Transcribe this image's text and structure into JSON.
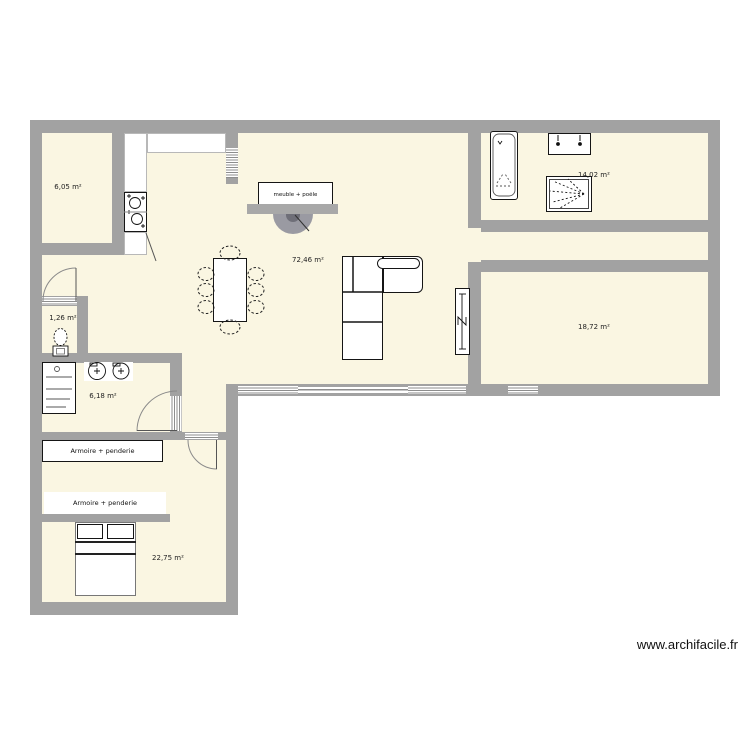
{
  "plan": {
    "title": "floor-plan",
    "watermark": "www.archifacile.fr",
    "colors": {
      "room_fill": "#faf6e2",
      "wall": "#a2a2a2",
      "furniture": "#ffffff",
      "stove": "#9a9aa2"
    },
    "rooms": {
      "storage": {
        "label": "6,05 m²"
      },
      "living": {
        "label": "72,46 m²"
      },
      "bath": {
        "label": "14,02 m²"
      },
      "wc": {
        "label": "1,26 m²"
      },
      "suite": {
        "label": "18,72 m²"
      },
      "laundry": {
        "label": "6,18 m²"
      },
      "bedroom": {
        "label": "22,75 m²"
      }
    },
    "furniture": {
      "wardrobe1": "Armoire + penderie",
      "wardrobe2": "Armoire + penderie",
      "stove": "meuble + poêle"
    }
  }
}
